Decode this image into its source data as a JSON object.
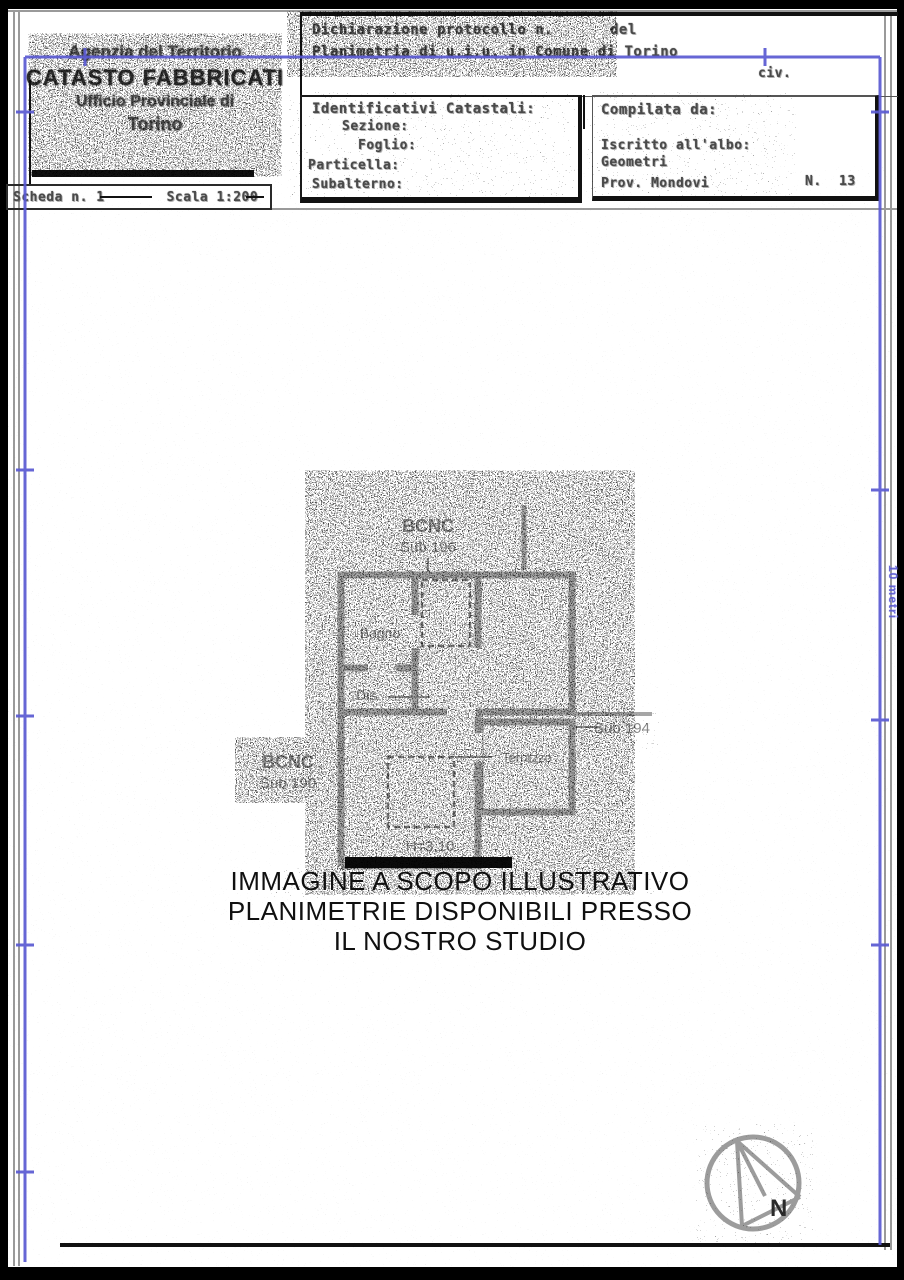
{
  "document": {
    "agency": {
      "line1": "Agenzia del Territorio",
      "line2": "CATASTO FABBRICATI",
      "line3": "Ufficio Provinciale di",
      "line4": "Torino"
    },
    "schedule": {
      "scheda": "Scheda n. 1",
      "scala": "Scala 1:200"
    },
    "declaration": {
      "protocol": "Dichiarazione protocollo n.",
      "del": "del",
      "subject": "Planimetria di u.i.u. in Comune di Torino",
      "civ": "civ."
    },
    "identifiers": {
      "title": "Identificativi Catastali:",
      "fields": [
        "Sezione:",
        "Foglio:",
        "Particella:",
        "Subalterno:"
      ]
    },
    "compiler": {
      "title": "Compilata da:",
      "albo": "Iscritto all'albo:",
      "category": "Geometri",
      "province": "Prov. Mondovi",
      "number_label": "N.",
      "number": "13"
    }
  },
  "plan": {
    "labels": {
      "bcnc_top_1": "BCNC",
      "bcnc_top_2": "Sub 196",
      "bagno": "Bagno",
      "dis": "Dis.",
      "terrazzo": "Terrazzo",
      "sub_right": "Sub 194",
      "bcnc_left_1": "BCNC",
      "bcnc_left_2": "Sub 190",
      "height": "H=3.10"
    }
  },
  "watermark": {
    "line1": "IMMAGINE A SCOPO ILLUSTRATIVO",
    "line2": "PLANIMETRIE DISPONIBILI PRESSO",
    "line3": "IL NOSTRO STUDIO"
  },
  "compass": {
    "north": "N"
  },
  "ruler": {
    "label": "10 metri"
  },
  "colors": {
    "frame_blue": "#5a5ad2",
    "wall_gray": "#a6a6a6",
    "ink": "#1a1a1a"
  }
}
